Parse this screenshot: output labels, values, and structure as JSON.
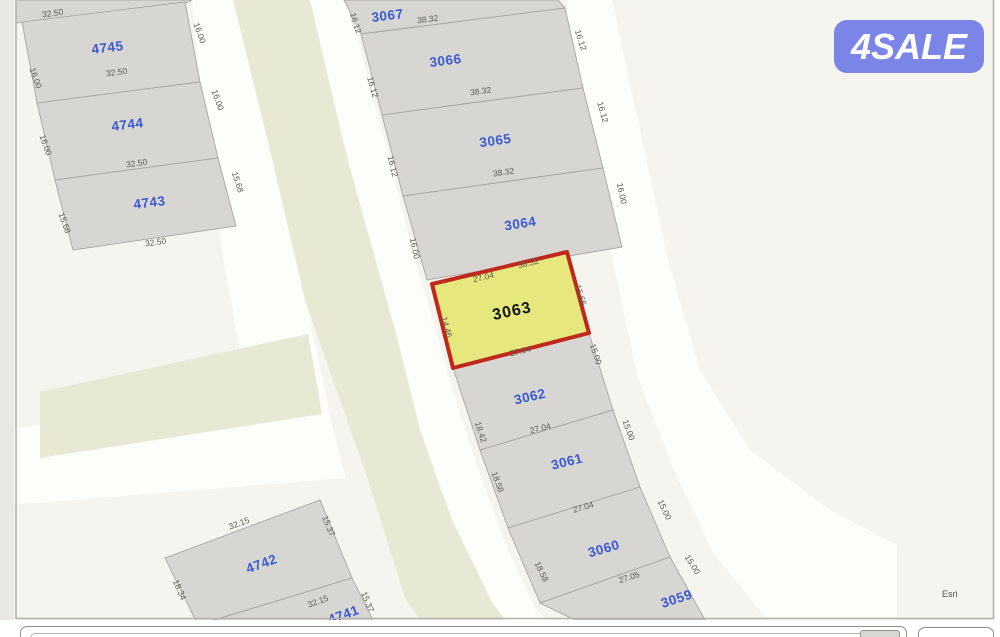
{
  "logo": {
    "text": "4SALE"
  },
  "attribution": {
    "text": "Esri"
  },
  "colors": {
    "logo_bg": "#7b85e8",
    "map_bg": "#f5f4ee",
    "road_white": "#fdfdfa",
    "green_area": "#e7e9d4",
    "parcel_fill": "#d7d6d3",
    "parcel_number_blue": "#3a5bd0",
    "dimension_gray": "#5a5951",
    "highlight_fill": "#e6e77c",
    "highlight_border": "#c0281c"
  },
  "parcels": [
    {
      "label": "4745"
    },
    {
      "label": "4744"
    },
    {
      "label": "4743"
    },
    {
      "label": "3067"
    },
    {
      "label": "3066"
    },
    {
      "label": "3065"
    },
    {
      "label": "3064"
    },
    {
      "label": "3063"
    },
    {
      "label": "3062"
    },
    {
      "label": "3061"
    },
    {
      "label": "3060"
    },
    {
      "label": "3059"
    },
    {
      "label": "4742"
    },
    {
      "label": "4741"
    }
  ],
  "dims": [
    "32.50",
    "32.50",
    "32.50",
    "32.50",
    "16.00",
    "16.00",
    "15.68",
    "16.00",
    "16.00",
    "15.68",
    "16.12",
    "16.12",
    "16.12",
    "16.00",
    "16.12",
    "16.12",
    "16.00",
    "38.32",
    "38.32",
    "38.32",
    "38.32",
    "27.04",
    "27.04",
    "14.46",
    "15.66",
    "15.00",
    "15.00",
    "15.00",
    "15.00",
    "18.42",
    "18.58",
    "18.58",
    "27.04",
    "27.04",
    "27.05",
    "32.15",
    "15.37",
    "18.34",
    "32.15",
    "15.37"
  ]
}
